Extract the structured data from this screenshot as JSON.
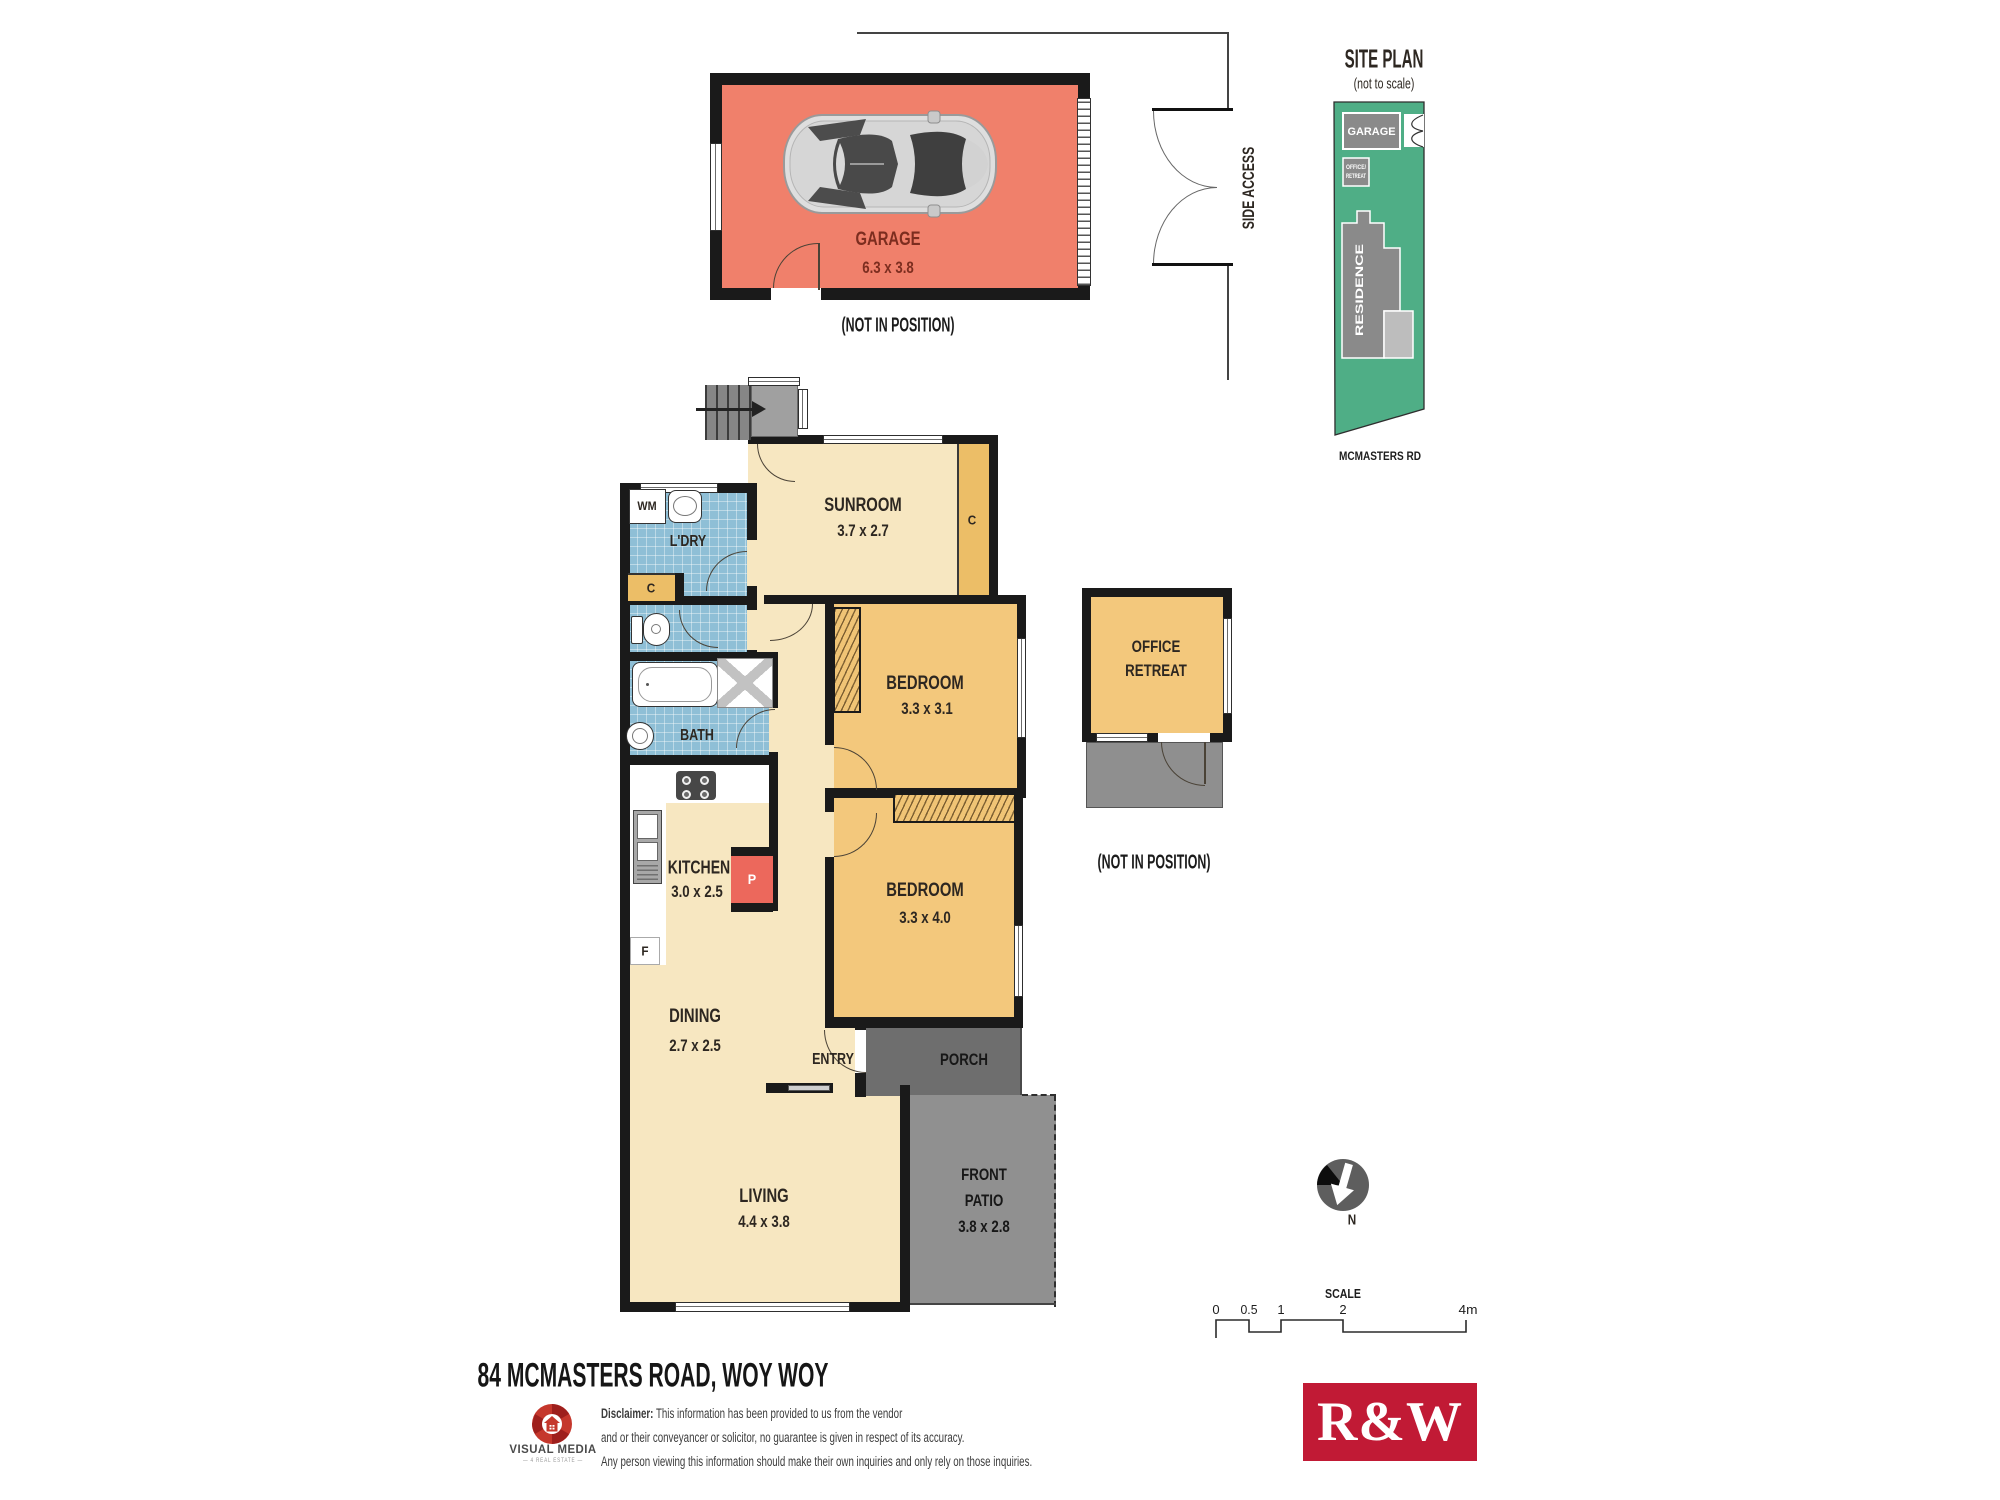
{
  "colors": {
    "wall": "#1a1a1a",
    "cream_room": "#F7E7C1",
    "orange_room": "#F3C87C",
    "closet_orange": "#ECBE67",
    "tile_blue": "#8FBFD6",
    "garage_salmon": "#F0806B",
    "pantry_red": "#EC685C",
    "porch_gray": "#6E6E6E",
    "patio_gray": "#909090",
    "site_green": "#4FAE86",
    "rw_red": "#C11A35"
  },
  "plan": {
    "garage": {
      "name": "GARAGE",
      "dims": "6.3 x 3.8",
      "note": "(NOT IN POSITION)"
    },
    "side_access": "SIDE ACCESS",
    "sunroom": {
      "name": "SUNROOM",
      "dims": "3.7 x 2.7"
    },
    "sunroom_cupboard": "C",
    "laundry": {
      "name": "L'DRY",
      "wm": "WM",
      "cupboard": "C"
    },
    "bath": "BATH",
    "kitchen": {
      "name": "KITCHEN",
      "dims": "3.0 x 2.5",
      "pantry": "P",
      "fridge": "F"
    },
    "dining": {
      "name": "DINING",
      "dims": "2.7 x 2.5"
    },
    "living": {
      "name": "LIVING",
      "dims": "4.4 x 3.8"
    },
    "entry": "ENTRY",
    "porch": "PORCH",
    "patio": {
      "line1": "FRONT",
      "line2": "PATIO",
      "dims": "3.8 x 2.8"
    },
    "bedroom1": {
      "name": "BEDROOM",
      "dims": "3.3 x 3.1"
    },
    "bedroom2": {
      "name": "BEDROOM",
      "dims": "3.3 x 4.0"
    },
    "office": {
      "line1": "OFFICE",
      "line2": "RETREAT",
      "note": "(NOT IN POSITION)"
    }
  },
  "site_plan": {
    "title": "SITE PLAN",
    "subtitle": "(not to scale)",
    "garage": "GARAGE",
    "office1": "OFFICE/",
    "office2": "RETREAT",
    "residence": "RESIDENCE",
    "road": "MCMASTERS RD"
  },
  "north": "N",
  "scale": {
    "title": "SCALE",
    "t0": "0",
    "t1": "0.5",
    "t2": "1",
    "t3": "2",
    "t4": "4m"
  },
  "footer": {
    "address": "84 MCMASTERS ROAD, WOY WOY",
    "vm": "VISUAL MEDIA",
    "vm_sub": "— 4 REAL ESTATE —",
    "disc_label": "Disclaimer:",
    "disc1": " This information has been provided to us from the vendor",
    "disc2": "and or their conveyancer or solicitor, no guarantee is given in respect of its accuracy.",
    "disc3": "Any person viewing this information should make their own inquiries and only rely on those inquiries.",
    "rw": "R&W"
  }
}
